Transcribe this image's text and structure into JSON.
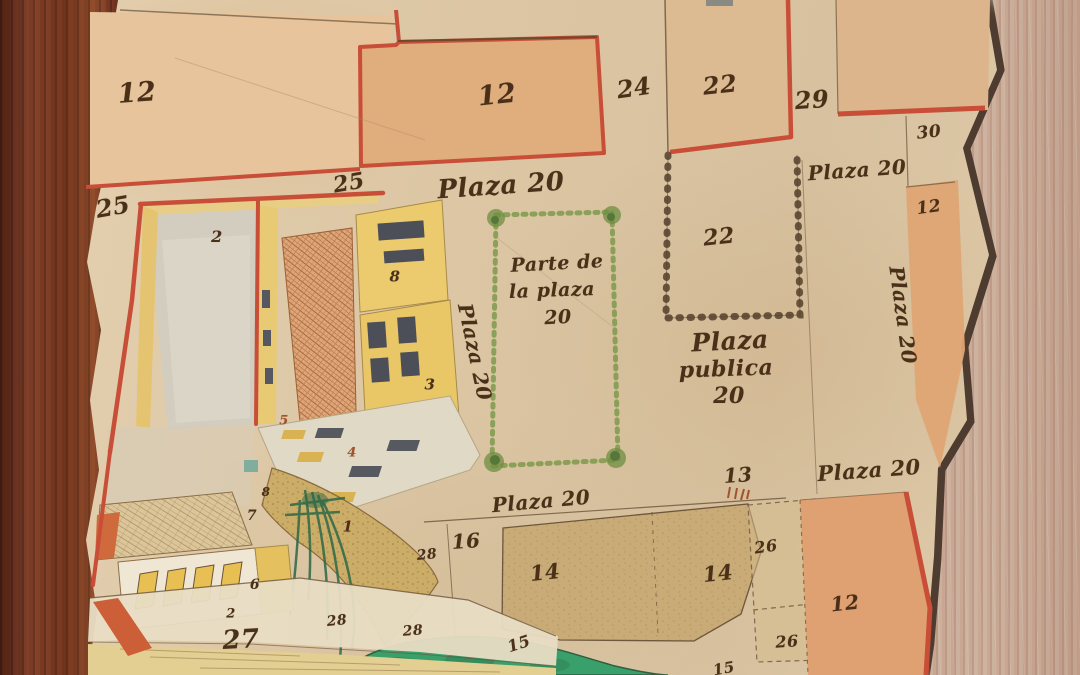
{
  "scene": {
    "kind": "historical hand-drawn town plat map in wooden frame",
    "language": "Spanish"
  },
  "colors": {
    "ink": "#4a3018",
    "ink_light": "#6b543a",
    "red_line": "#c84e38",
    "red_numeral": "#a0522d",
    "paper": "#dcc6a4",
    "wood_frame_left": "#7c3a26",
    "wood_panel_right": "#c9ae9b",
    "parcel_peach": "#e7c49c",
    "parcel_orange": "#e0ad7d",
    "parcel_tan": "#dcba92",
    "parcel_olive": "#c8ab76",
    "parcel_orange_south": "#dfa171",
    "chain_border": "#54402c",
    "green_stipple": "#7d9a4c",
    "pond_green": "#3aa06b",
    "building_yellow": "#e9c766",
    "brick_roof": "#dfa678",
    "courtyard_grey": "#d2cdbf",
    "curved_wall": "#ccad68",
    "plant_green": "#2d6847",
    "street_band": "#e8ddc4"
  },
  "labels": [
    {
      "name": "lot-12-northwest",
      "text": "12",
      "x": 137,
      "y": 93,
      "size": 27,
      "rot": -4
    },
    {
      "name": "lot-25-west",
      "text": "25",
      "x": 113,
      "y": 207,
      "size": 24,
      "rot": -10
    },
    {
      "name": "lot-25-north",
      "text": "25",
      "x": 349,
      "y": 183,
      "size": 22,
      "rot": -10
    },
    {
      "name": "lot-12-north",
      "text": "12",
      "x": 497,
      "y": 95,
      "size": 27,
      "rot": -6
    },
    {
      "name": "lot-24",
      "text": "24",
      "x": 634,
      "y": 88,
      "size": 24,
      "rot": -8
    },
    {
      "name": "lot-22-north",
      "text": "22",
      "x": 720,
      "y": 85,
      "size": 24,
      "rot": -6
    },
    {
      "name": "lot-29",
      "text": "29",
      "x": 812,
      "y": 100,
      "size": 24,
      "rot": -4
    },
    {
      "name": "lot-30",
      "text": "30",
      "x": 929,
      "y": 133,
      "size": 17,
      "rot": -6
    },
    {
      "name": "street-plaza-20-north",
      "text": "Plaza 20",
      "x": 501,
      "y": 186,
      "size": 26,
      "rot": -4
    },
    {
      "name": "street-plaza-20-northeast",
      "text": "Plaza 20",
      "x": 857,
      "y": 170,
      "size": 20,
      "rot": -4
    },
    {
      "name": "lot-12-east",
      "text": "12",
      "x": 929,
      "y": 208,
      "size": 17,
      "rot": -8
    },
    {
      "name": "street-plaza-20-east",
      "text": "Plaza 20",
      "x": 903,
      "y": 315,
      "size": 20,
      "rot": 82
    },
    {
      "name": "lot-22-chained",
      "text": "22",
      "x": 719,
      "y": 237,
      "size": 22,
      "rot": -6
    },
    {
      "name": "plaza-note-line-1",
      "text": "Parte de",
      "x": 557,
      "y": 264,
      "size": 19,
      "rot": -3
    },
    {
      "name": "plaza-note-line-2",
      "text": "la plaza",
      "x": 552,
      "y": 291,
      "size": 19,
      "rot": -2
    },
    {
      "name": "plaza-note-line-3",
      "text": "20",
      "x": 558,
      "y": 318,
      "size": 19,
      "rot": -3
    },
    {
      "name": "street-plaza-20-west",
      "text": "Plaza 20",
      "x": 475,
      "y": 352,
      "size": 20,
      "rot": 78
    },
    {
      "name": "plaza-publica-line-1",
      "text": "Plaza",
      "x": 730,
      "y": 341,
      "size": 25,
      "rot": -3
    },
    {
      "name": "plaza-publica-line-2",
      "text": "publica",
      "x": 726,
      "y": 369,
      "size": 22,
      "rot": -2
    },
    {
      "name": "plaza-publica-line-3",
      "text": "20",
      "x": 729,
      "y": 396,
      "size": 22,
      "rot": 0
    },
    {
      "name": "street-plaza-20-south",
      "text": "Plaza 20",
      "x": 541,
      "y": 501,
      "size": 20,
      "rot": -5
    },
    {
      "name": "street-plaza-20-southeast",
      "text": "Plaza 20",
      "x": 869,
      "y": 470,
      "size": 21,
      "rot": -4
    },
    {
      "name": "lot-13",
      "text": "13",
      "x": 738,
      "y": 475,
      "size": 20,
      "rot": -4
    },
    {
      "name": "lot-16",
      "text": "16",
      "x": 466,
      "y": 541,
      "size": 20,
      "rot": -4
    },
    {
      "name": "lot-14-west",
      "text": "14",
      "x": 545,
      "y": 572,
      "size": 21,
      "rot": -6
    },
    {
      "name": "lot-14-east",
      "text": "14",
      "x": 718,
      "y": 573,
      "size": 21,
      "rot": -6
    },
    {
      "name": "lot-26-north",
      "text": "26",
      "x": 766,
      "y": 547,
      "size": 16,
      "rot": -8
    },
    {
      "name": "lot-26-south",
      "text": "26",
      "x": 787,
      "y": 642,
      "size": 16,
      "rot": -4
    },
    {
      "name": "lot-12-south",
      "text": "12",
      "x": 845,
      "y": 603,
      "size": 20,
      "rot": -6
    },
    {
      "name": "lot-15-west",
      "text": "15",
      "x": 519,
      "y": 644,
      "size": 16,
      "rot": -18
    },
    {
      "name": "lot-15-east",
      "text": "15",
      "x": 724,
      "y": 669,
      "size": 15,
      "rot": -10
    },
    {
      "name": "lot-28-a",
      "text": "28",
      "x": 427,
      "y": 555,
      "size": 14,
      "rot": -6
    },
    {
      "name": "lot-28-b",
      "text": "28",
      "x": 337,
      "y": 621,
      "size": 14,
      "rot": -6
    },
    {
      "name": "lot-28-c",
      "text": "28",
      "x": 413,
      "y": 631,
      "size": 14,
      "rot": -4
    },
    {
      "name": "lot-27",
      "text": "27",
      "x": 241,
      "y": 640,
      "size": 26,
      "rot": -3
    },
    {
      "name": "lot-2-south",
      "text": "2",
      "x": 231,
      "y": 614,
      "size": 13,
      "rot": 0
    },
    {
      "name": "building-2",
      "text": "2",
      "x": 217,
      "y": 237,
      "size": 16,
      "rot": 0
    },
    {
      "name": "building-8-upper",
      "text": "8",
      "x": 395,
      "y": 277,
      "size": 15,
      "rot": 0
    },
    {
      "name": "building-3",
      "text": "3",
      "x": 430,
      "y": 385,
      "size": 15,
      "rot": 0
    },
    {
      "name": "building-5",
      "text": "5",
      "x": 284,
      "y": 421,
      "size": 13,
      "rot": 0,
      "color": "#a0522d"
    },
    {
      "name": "building-4",
      "text": "4",
      "x": 352,
      "y": 453,
      "size": 13,
      "rot": 0,
      "color": "#a0522d"
    },
    {
      "name": "building-7",
      "text": "7",
      "x": 252,
      "y": 516,
      "size": 14,
      "rot": 0
    },
    {
      "name": "building-8-lower",
      "text": "8",
      "x": 266,
      "y": 492,
      "size": 12,
      "rot": 0
    },
    {
      "name": "building-1",
      "text": "1",
      "x": 348,
      "y": 527,
      "size": 15,
      "rot": 0
    },
    {
      "name": "building-6",
      "text": "6",
      "x": 255,
      "y": 585,
      "size": 14,
      "rot": 0
    }
  ]
}
